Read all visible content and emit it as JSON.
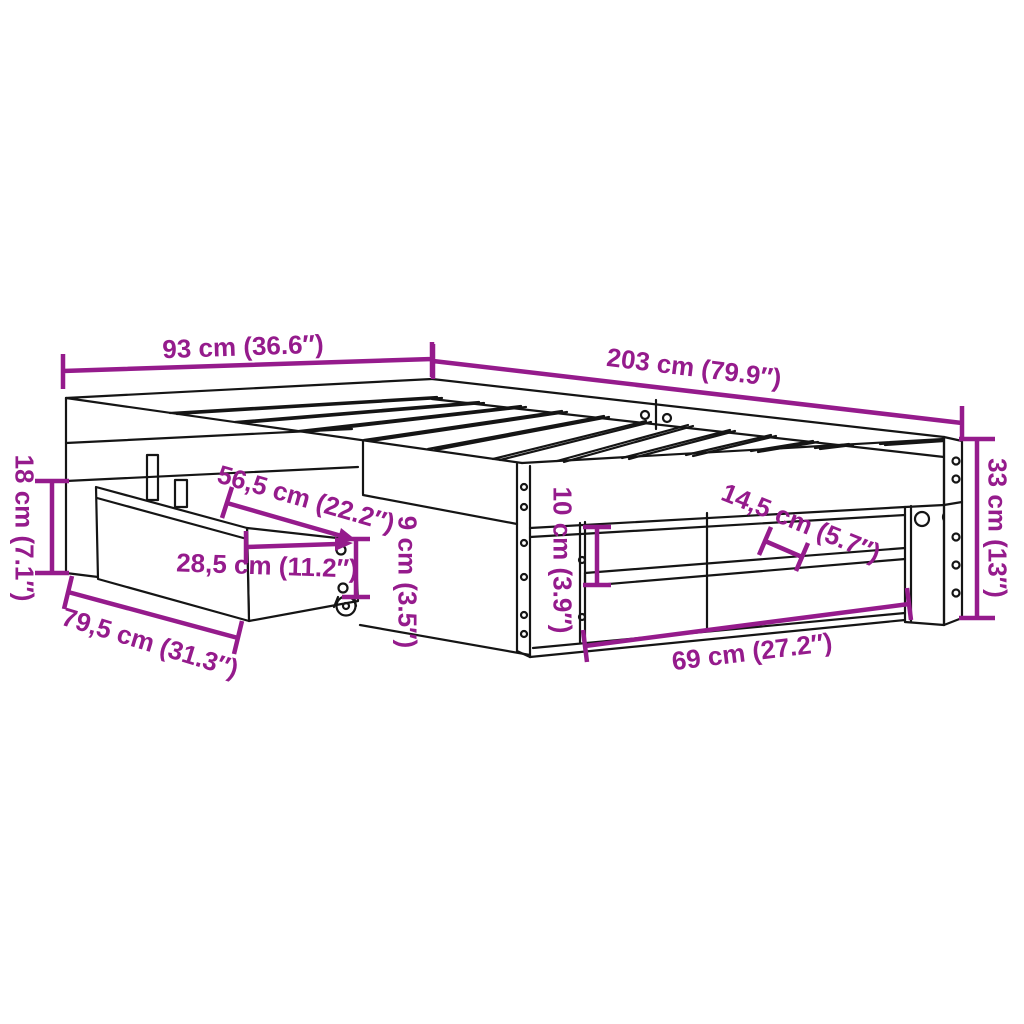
{
  "diagram": {
    "type": "product-dimension-diagram",
    "subject": "bed frame with pull-out drawer, slatted base and under-bed shelf",
    "background_color": "#ffffff",
    "dimension_color": "#951B8C",
    "line_art_color": "#151515"
  },
  "dims": [
    {
      "id": "dim-93cm",
      "label": "93 cm (36.6″)"
    },
    {
      "id": "dim-203cm",
      "label": "203 cm (79.9″)"
    },
    {
      "id": "dim-33cm",
      "label": "33 cm (13″)"
    },
    {
      "id": "dim-18cm",
      "label": "18 cm (7.1″)"
    },
    {
      "id": "dim-79-5cm",
      "label": "79,5 cm (31.3″)"
    },
    {
      "id": "dim-56-5cm",
      "label": "56,5 cm (22.2″)"
    },
    {
      "id": "dim-28-5cm",
      "label": "28,5 cm (11.2″)"
    },
    {
      "id": "dim-9cm",
      "label": "9 cm (3.5″)"
    },
    {
      "id": "dim-10cm",
      "label": "10 cm (3.9″)"
    },
    {
      "id": "dim-14-5cm",
      "label": "14,5 cm (5.7″)"
    },
    {
      "id": "dim-69cm",
      "label": "69 cm (27.2″)"
    }
  ]
}
